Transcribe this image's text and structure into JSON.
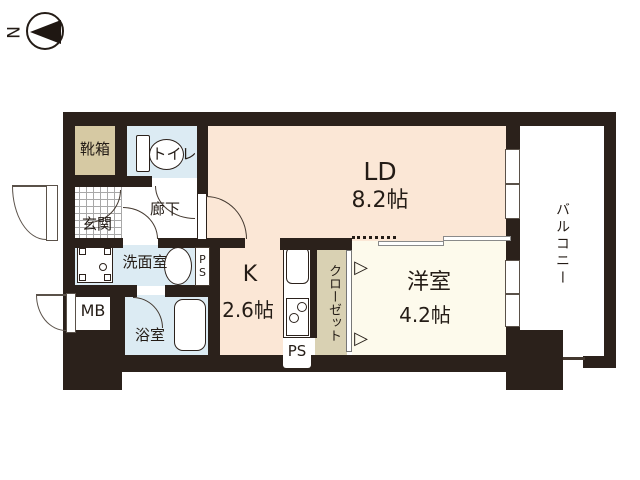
{
  "compass": {
    "north_label": "N"
  },
  "rooms": {
    "shoebox": {
      "label": "靴箱"
    },
    "toilet": {
      "label": "トイレ"
    },
    "entrance": {
      "label": "玄関"
    },
    "hallway": {
      "label": "廊下"
    },
    "living_dining": {
      "label": "LD",
      "size": "8.2帖"
    },
    "kitchen": {
      "label": "K",
      "size": "2.6帖"
    },
    "western_room": {
      "label": "洋室",
      "size": "4.2帖"
    },
    "closet": {
      "label": "クローゼット"
    },
    "balcony": {
      "label": "バルコニー"
    },
    "washroom": {
      "label": "洗面室"
    },
    "bathroom": {
      "label": "浴室"
    },
    "meter_box": {
      "label": "MB"
    },
    "pipe_space_upper": {
      "label": "PS"
    },
    "pipe_space_lower": {
      "label": "PS"
    }
  },
  "icons": {
    "sliding_door_arrow": "▷"
  },
  "colors": {
    "wall": "#2b211b",
    "living_dining_floor": "#fbe7d6",
    "western_room_floor": "#fdfaec",
    "wet_area_floor": "#dcebf3",
    "shoebox_floor": "#d6c9a3",
    "closet_floor": "#d9d1b3"
  }
}
